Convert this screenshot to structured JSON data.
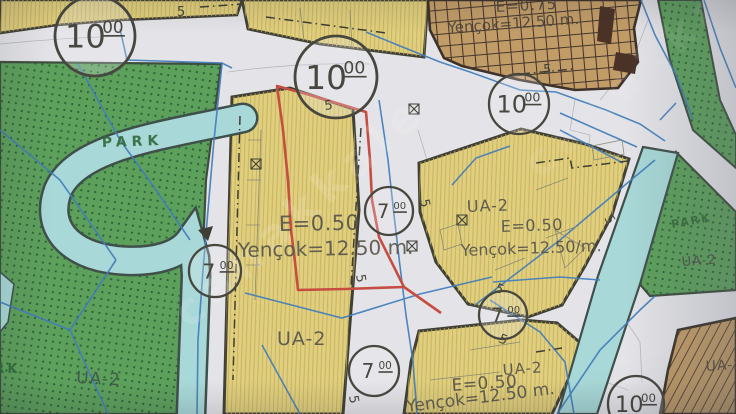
{
  "map": {
    "type": "zoning-plan-photo",
    "palette": {
      "road": "#e7e7ec",
      "block_yellow": "#e5d278",
      "block_hatch": "#c8b258",
      "park_green": "#58a257",
      "park_dots": "#1e5a2a",
      "river_teal": "#a6dcda",
      "river_casing": "#3c4f49",
      "commercial_tan": "#c69d62",
      "grid_line": "#44332a",
      "zone_border": "#3e3e32",
      "cadastral_blue": "#3c7ec2",
      "parcel_red": "#d04a3d",
      "label_gray": "#55534a",
      "park_label_green": "#2f6b36"
    },
    "road_circles": [
      {
        "label": "10",
        "sup": "00",
        "x": 95,
        "y": 36,
        "r": 40
      },
      {
        "label": "10",
        "sup": "00",
        "x": 336,
        "y": 77,
        "r": 41
      },
      {
        "label": "10",
        "sup": "00",
        "x": 519,
        "y": 104,
        "r": 30
      },
      {
        "label": "7",
        "sup": "00",
        "x": 215,
        "y": 271,
        "r": 26
      },
      {
        "label": "7",
        "sup": "00",
        "x": 389,
        "y": 211,
        "r": 24
      },
      {
        "label": "7",
        "sup": "00",
        "x": 374,
        "y": 371,
        "r": 25
      },
      {
        "label": "7",
        "sup": "00",
        "x": 503,
        "y": 315,
        "r": 24
      },
      {
        "label": "10",
        "sup": "00",
        "x": 636,
        "y": 404,
        "r": 28
      }
    ],
    "labels": [
      {
        "id": "park-left-name",
        "text": "PARK",
        "x": 102,
        "y": 147,
        "size": 14,
        "color": "#2f6b36",
        "rot": -2,
        "ls": 5,
        "bold": true
      },
      {
        "id": "park-left-name-2",
        "text": "PARK",
        "x": -30,
        "y": 373,
        "size": 13,
        "color": "#2f6b36",
        "rot": 0,
        "ls": 3,
        "bold": true
      },
      {
        "id": "park-left-ua2",
        "text": "UA-2",
        "x": 76,
        "y": 383,
        "size": 17,
        "color": "#3c554a",
        "rot": 3,
        "ls": 1
      },
      {
        "id": "center-block-e",
        "text": "E=0.50",
        "x": 279,
        "y": 231,
        "size": 21,
        "color": "#57554a",
        "rot": -1,
        "ls": 0.5
      },
      {
        "id": "center-block-yencok",
        "text": "Yençok=12.50 m.",
        "x": 238,
        "y": 257,
        "size": 20,
        "color": "#57554a",
        "rot": -1,
        "ls": 0
      },
      {
        "id": "center-block-ua2",
        "text": "UA-2",
        "x": 277,
        "y": 345,
        "size": 19,
        "color": "#55534a",
        "rot": 0,
        "ls": 1
      },
      {
        "id": "right-block-ua2",
        "text": "UA-2",
        "x": 467,
        "y": 212,
        "size": 16,
        "color": "#55534a",
        "rot": -2,
        "ls": 1
      },
      {
        "id": "right-block-e",
        "text": "E=0.50",
        "x": 501,
        "y": 232,
        "size": 16,
        "color": "#55534a",
        "rot": -2,
        "ls": 0.5
      },
      {
        "id": "right-block-yencok",
        "text": "Yençok=12.50/m.",
        "x": 461,
        "y": 256,
        "size": 16,
        "color": "#55534a",
        "rot": -2,
        "ls": 0
      },
      {
        "id": "topright-zone-e",
        "text": "E=0.75",
        "x": 496,
        "y": 12,
        "size": 15,
        "color": "#4c4338",
        "rot": -3,
        "ls": 1
      },
      {
        "id": "topright-zone-yencok",
        "text": "Yençok=12.50 m.",
        "x": 448,
        "y": 33,
        "size": 15,
        "color": "#4c4338",
        "rot": -4,
        "ls": 0
      },
      {
        "id": "bottom-block-ua2",
        "text": "UA-2",
        "x": 503,
        "y": 375,
        "size": 15,
        "color": "#55534a",
        "rot": -4,
        "ls": 1
      },
      {
        "id": "bottom-block-e",
        "text": "E=0.50",
        "x": 452,
        "y": 391,
        "size": 17,
        "color": "#55534a",
        "rot": -4,
        "ls": 0.5
      },
      {
        "id": "bottom-block-yencok",
        "text": "Yençok=12.50 m.",
        "x": 407,
        "y": 412,
        "size": 17,
        "color": "#55534a",
        "rot": -7,
        "ls": 0
      },
      {
        "id": "park-right-name",
        "text": "PARK",
        "x": 672,
        "y": 228,
        "size": 11,
        "color": "#2f6b36",
        "rot": -10,
        "ls": 2,
        "bold": true
      },
      {
        "id": "park-right-ua2",
        "text": "UA-2",
        "x": 682,
        "y": 266,
        "size": 13,
        "color": "#4a4a42",
        "rot": -4,
        "ls": 1
      },
      {
        "id": "bottomright-ua2",
        "text": "UA-2",
        "x": 706,
        "y": 371,
        "size": 14,
        "color": "#4c4338",
        "rot": -4,
        "ls": 1
      }
    ],
    "road_width_markers": [
      {
        "text": "5",
        "x": 177,
        "y": 16,
        "rot": 0
      },
      {
        "text": "5",
        "x": 325,
        "y": 110,
        "rot": -8
      },
      {
        "text": "5",
        "x": 543,
        "y": 74,
        "rot": 0
      },
      {
        "text": "5",
        "x": 420,
        "y": 200,
        "rot": 78
      },
      {
        "text": "5",
        "x": 356,
        "y": 275,
        "rot": 80
      },
      {
        "text": "5",
        "x": 349,
        "y": 396,
        "rot": 80
      },
      {
        "text": "5",
        "x": 604,
        "y": 218,
        "rot": 60
      },
      {
        "text": "5",
        "x": 494,
        "y": 291,
        "rot": 25
      },
      {
        "text": "5",
        "x": 498,
        "y": 342,
        "rot": 20
      }
    ],
    "watermarks": [
      {
        "text": "canakkale",
        "x": 190,
        "y": 330,
        "rot": -42,
        "size": 44,
        "opacity": 0.13,
        "ls": 8
      },
      {
        "text": "canakkale",
        "x": 540,
        "y": 180,
        "rot": -42,
        "size": 44,
        "opacity": 0.08,
        "ls": 8
      }
    ]
  }
}
